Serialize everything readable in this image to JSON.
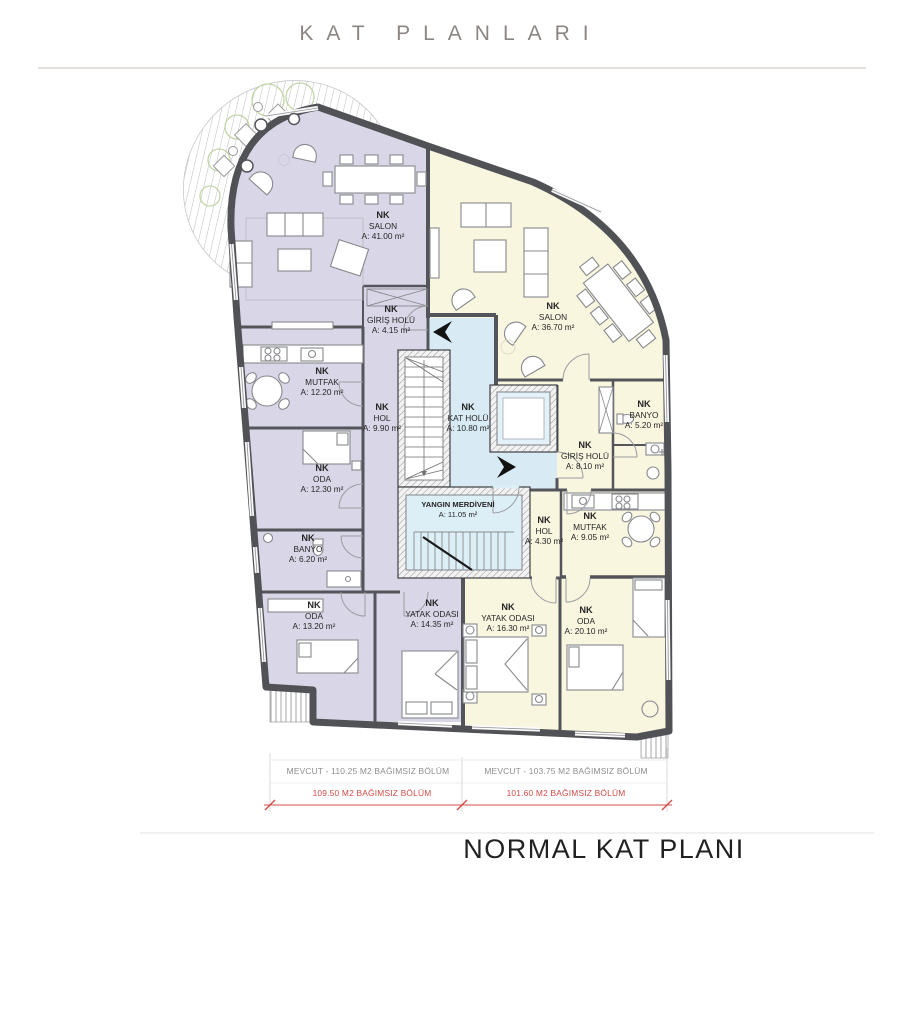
{
  "header": {
    "title": "KAT PLANLARI"
  },
  "footer": {
    "plan_title": "NORMAL KAT PLANI"
  },
  "rooms": [
    {
      "code": "NK",
      "name": "SALON",
      "area": "A: 41.00 m²"
    },
    {
      "code": "NK",
      "name": "GİRİŞ HOLÜ",
      "area": "A: 4.15 m²"
    },
    {
      "code": "NK",
      "name": "SALON",
      "area": "A: 36.70 m²"
    },
    {
      "code": "NK",
      "name": "MUTFAK",
      "area": "A: 12.20 m²"
    },
    {
      "code": "NK",
      "name": "HOL",
      "area": "A: 9.90 m²"
    },
    {
      "code": "NK",
      "name": "KAT HOLÜ",
      "area": "A: 10.80 m²"
    },
    {
      "code": "NK",
      "name": "BANYO",
      "area": "A: 5.20 m²"
    },
    {
      "code": "NK",
      "name": "ODA",
      "area": "A: 12.30 m²"
    },
    {
      "code": "NK",
      "name": "GİRİŞ HOLÜ",
      "area": "A: 8.10 m²"
    },
    {
      "code": "",
      "name": "YANGIN MERDİVENİ",
      "area": "A: 11.05 m²"
    },
    {
      "code": "NK",
      "name": "BANYO",
      "area": "A: 6.20 m²"
    },
    {
      "code": "NK",
      "name": "HOL",
      "area": "A: 4.30 m²"
    },
    {
      "code": "NK",
      "name": "MUTFAK",
      "area": "A: 9.05 m²"
    },
    {
      "code": "NK",
      "name": "ODA",
      "area": "A: 13.20 m²"
    },
    {
      "code": "NK",
      "name": "YATAK ODASI",
      "area": "A: 14.35 m²"
    },
    {
      "code": "NK",
      "name": "YATAK ODASI",
      "area": "A: 16.30 m²"
    },
    {
      "code": "NK",
      "name": "ODA",
      "area": "A: 20.10 m²"
    }
  ],
  "dimensions": {
    "left_existing": "MEVCUT - 110.25 M2 BAĞIMSIZ BÖLÜM",
    "right_existing": "MEVCUT - 103.75 M2 BAĞIMSIZ BÖLÜM",
    "left_new": "109.50 M2 BAĞIMSIZ BÖLÜM",
    "right_new": "101.60 M2 BAĞIMSIZ BÖLÜM"
  },
  "colors": {
    "unit_left": "#d9d7e7",
    "unit_right": "#f9f6e0",
    "core": "#d8eaf3",
    "core_inner": "#dceef6",
    "wall": "#54555a",
    "dimension_red": "#d14b45",
    "tree_green": "#c3d4a6"
  }
}
